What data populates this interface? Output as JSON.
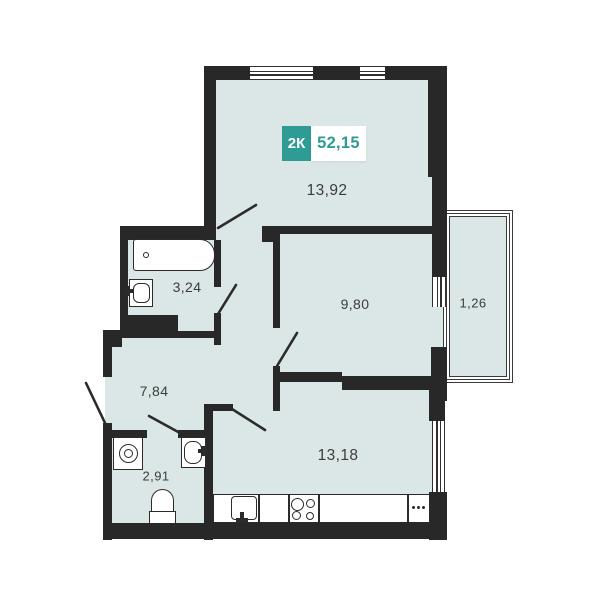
{
  "badge": {
    "rooms_label": "2К",
    "total_area": "52,15"
  },
  "rooms": {
    "living": {
      "name": "living-room",
      "area": "13,92"
    },
    "bathroom": {
      "name": "bathroom",
      "area": "3,24"
    },
    "bedroom": {
      "name": "bedroom",
      "area": "9,80"
    },
    "balcony": {
      "name": "balcony",
      "area": "1,26"
    },
    "hallway": {
      "name": "hallway",
      "area": "7,84"
    },
    "wc": {
      "name": "wc",
      "area": "2,91"
    },
    "kitchen": {
      "name": "kitchen",
      "area": "13,18"
    }
  },
  "icons": [
    "bathtub-icon",
    "bath-sink-icon",
    "washing-machine-icon",
    "wc-sink-icon",
    "toilet-icon",
    "kitchen-sink-icon",
    "stove-icon",
    "counter-dots-icon",
    "window-icon",
    "door-swing-icon"
  ],
  "colors": {
    "wall": "#282828",
    "room_fill": "#dbe7e6",
    "accent_teal": "#2e9b94",
    "label_text": "#3c3c3c",
    "background": "#ffffff"
  }
}
